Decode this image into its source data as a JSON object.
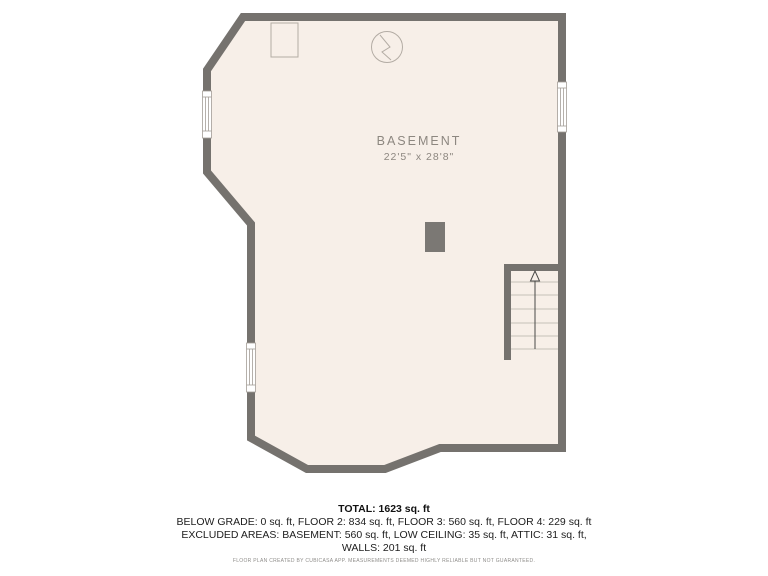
{
  "floor_plan": {
    "room_label": "BASEMENT",
    "room_dimensions": "22'5\" x 28'8\"",
    "symbols": [
      {
        "name": "fixture-square-icon",
        "shape": "square outline, top-left of room"
      },
      {
        "name": "water-heater-icon",
        "shape": "circle with zigzag line"
      },
      {
        "name": "support-post",
        "shape": "solid gray rectangle, room center"
      },
      {
        "name": "staircase",
        "shape": "six treads with up-direction arrow, right side"
      },
      {
        "name": "window",
        "count": 3,
        "locations": [
          "upper-left wall",
          "lower-left wall",
          "right wall"
        ]
      }
    ],
    "colors": {
      "wall": "#75726e",
      "floor": "#f7efe8",
      "background": "#ffffff",
      "symbol_stroke": "#b3aca4",
      "label_text": "#8d8780"
    }
  },
  "summary": {
    "total_line": "TOTAL: 1623 sq. ft",
    "floors_line": "BELOW GRADE: 0 sq. ft, FLOOR 2: 834 sq. ft, FLOOR 3: 560 sq. ft, FLOOR 4: 229 sq. ft",
    "excluded_line": "EXCLUDED AREAS: BASEMENT: 560 sq. ft, LOW CEILING: 35 sq. ft, ATTIC: 31 sq. ft,",
    "walls_line": "WALLS: 201 sq. ft"
  },
  "footer": {
    "disclaimer": "FLOOR PLAN CREATED BY CUBICASA APP. MEASUREMENTS DEEMED HIGHLY RELIABLE BUT NOT GUARANTEED."
  }
}
